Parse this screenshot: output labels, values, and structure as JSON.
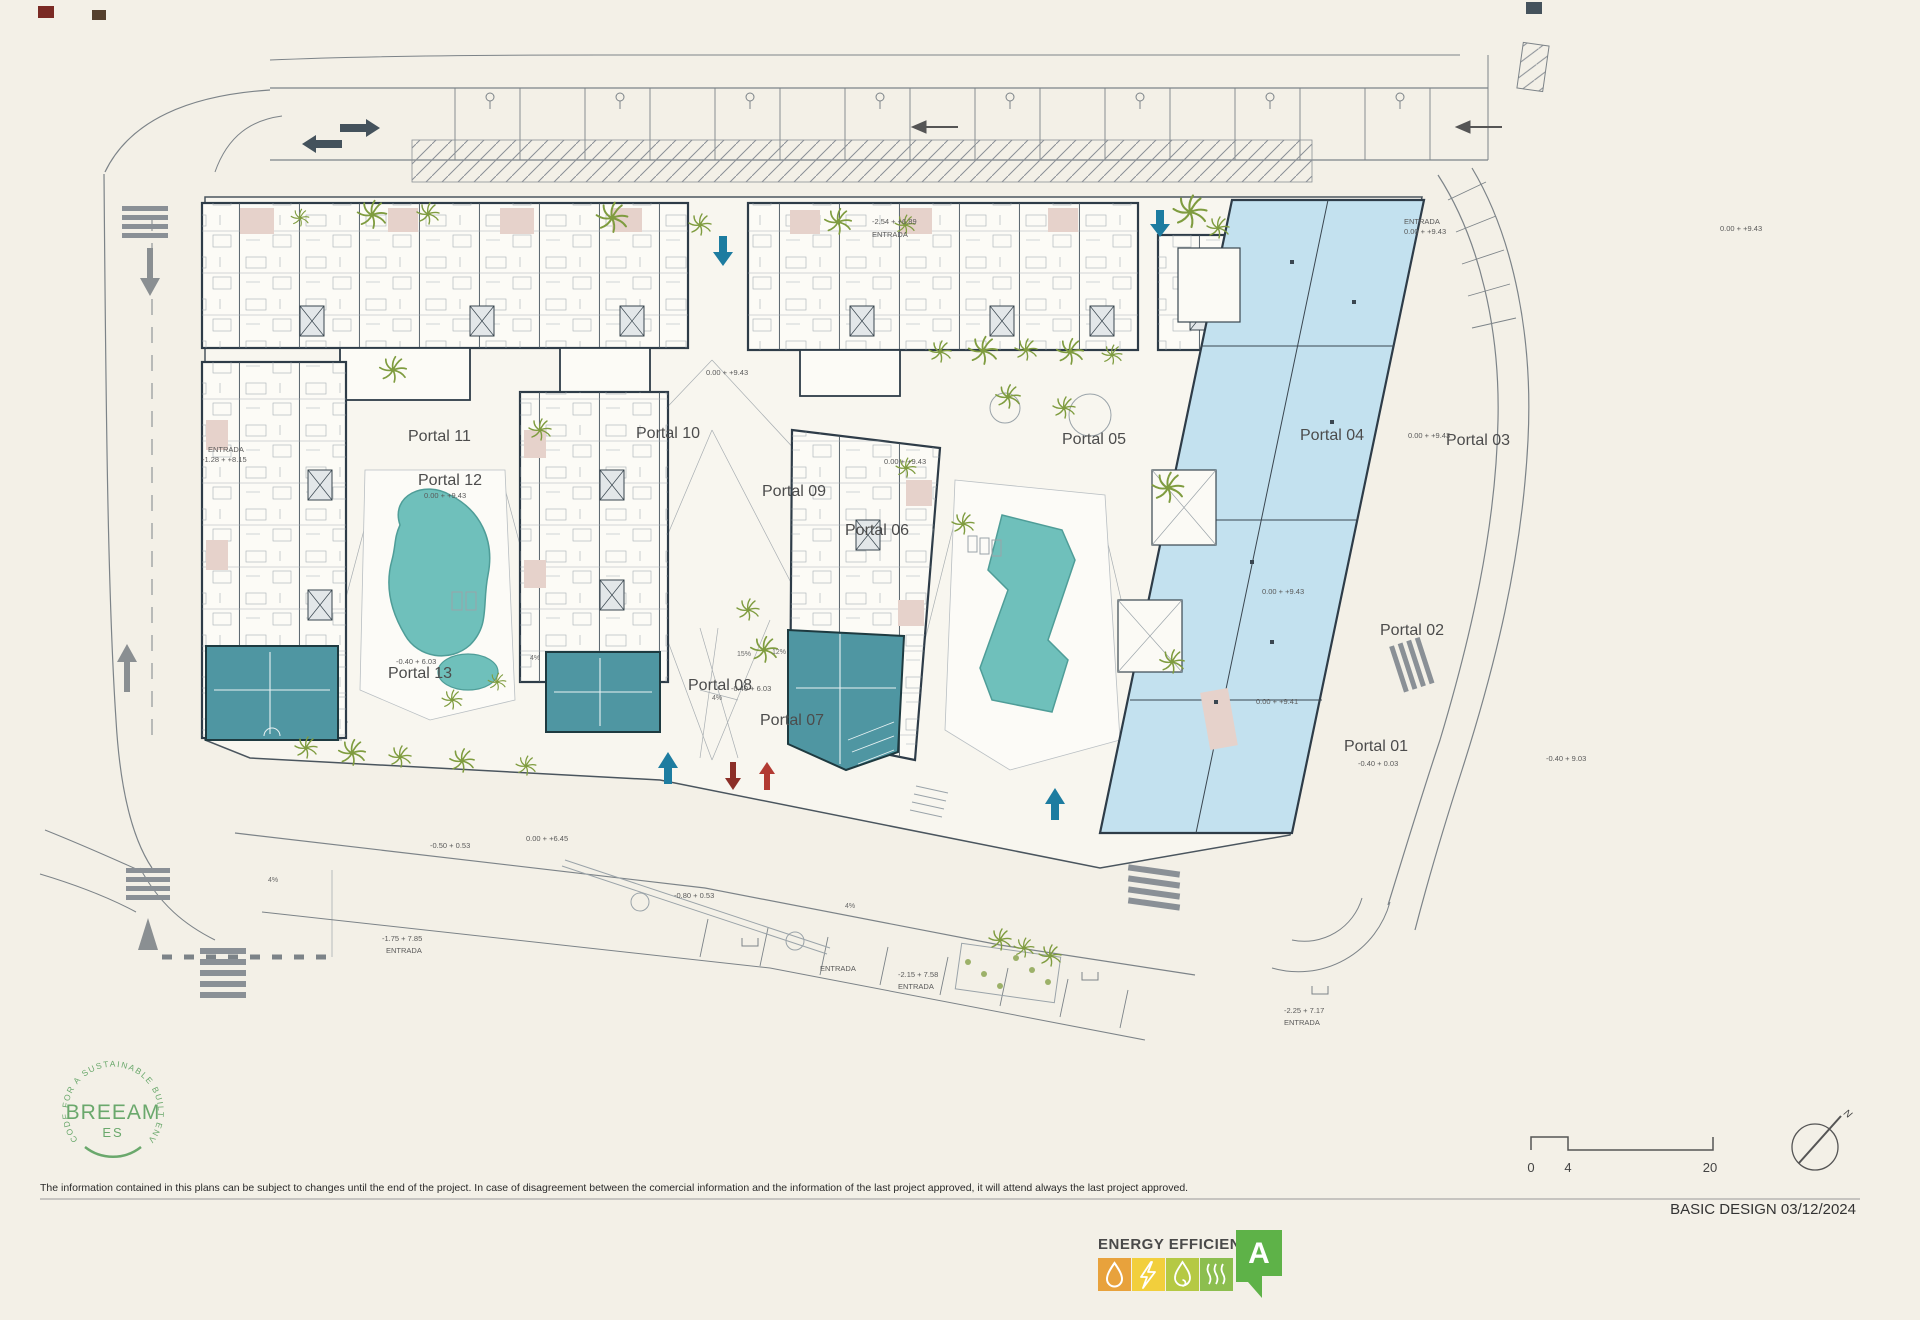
{
  "plan": {
    "portals": [
      "Portal 01",
      "Portal 02",
      "Portal 03",
      "Portal 04",
      "Portal 05",
      "Portal 06",
      "Portal 07",
      "Portal 08",
      "Portal 09",
      "Portal 10",
      "Portal 11",
      "Portal 12",
      "Portal 13"
    ],
    "elevations": [
      "0.00 + +9.43",
      "0.00 + +9.43",
      "0.00 + +9.43",
      "0.00 + +9.43",
      "0.00 + +9.43",
      "0.00 + +9.41",
      "-0.40 + 6.03",
      "-0.40 + 6.03",
      "0.00 + +6.45",
      "-0.50 + 0.53",
      "-0.80 + 0.53",
      "-0.40 + 0.03",
      "-0.40 + 9.03",
      "0.00 + +9.43"
    ],
    "slopes": [
      "4%",
      "4%",
      "4%",
      "4%",
      "15%",
      "12%"
    ],
    "entrances": [
      {
        "line1": "-2.54 + +6.89",
        "line2": "ENTRADA"
      },
      {
        "line1": "ENTRADA",
        "line2": "0.00 + +9.43"
      },
      {
        "line1": "ENTRADA",
        "line2": "-1.28 + +8.15"
      },
      {
        "line1": "-1.75 + 7.85",
        "line2": "ENTRADA"
      },
      {
        "line1": "ENTRADA",
        "line2": ""
      },
      {
        "line1": "-2.15 + 7.58",
        "line2": "ENTRADA"
      },
      {
        "line1": "-2.25 + 7.17",
        "line2": "ENTRADA"
      }
    ]
  },
  "breeam": {
    "arc": "CODE FOR A SUSTAINABLE BUILT ENVIRONMENT",
    "name": "BREEAM",
    "region": "ES"
  },
  "energy": {
    "title": "ENERGY EFFICIENCY",
    "rating": "A"
  },
  "footer": {
    "disclaimer": "The information contained in this plans can be subject to changes until the end of the project. In case of disagreement between the comercial information and the information of the last project approved, it will attend always the last project approved.",
    "stamp": "BASIC DESIGN 03/12/2024"
  },
  "scalebar": {
    "ticks": [
      "0",
      "4",
      "20"
    ]
  },
  "compass": {
    "label": "N"
  },
  "colors": {
    "paper": "#f3f0e7",
    "site_fill": "#f8f6ef",
    "building_fill": "#fcfbf6",
    "outline": "#2e3c48",
    "road_gray": "#7c8388",
    "pool": "#6fc0bb",
    "commercial_light": "#c3e1ef",
    "commercial_dark": "#4f96a2",
    "terrace_pink": "#e6d2cb",
    "landscape_green": "#7f9c3f",
    "breeam_green": "#6aa86c",
    "arrow_blue": "#1d7ca0",
    "arrow_red": "#b23a32",
    "energy_water": "#e8a23c",
    "energy_power": "#f2cf3c",
    "energy_flame": "#b5c944",
    "energy_heat": "#8cbe4f",
    "energy_rating": "#5eb248"
  }
}
